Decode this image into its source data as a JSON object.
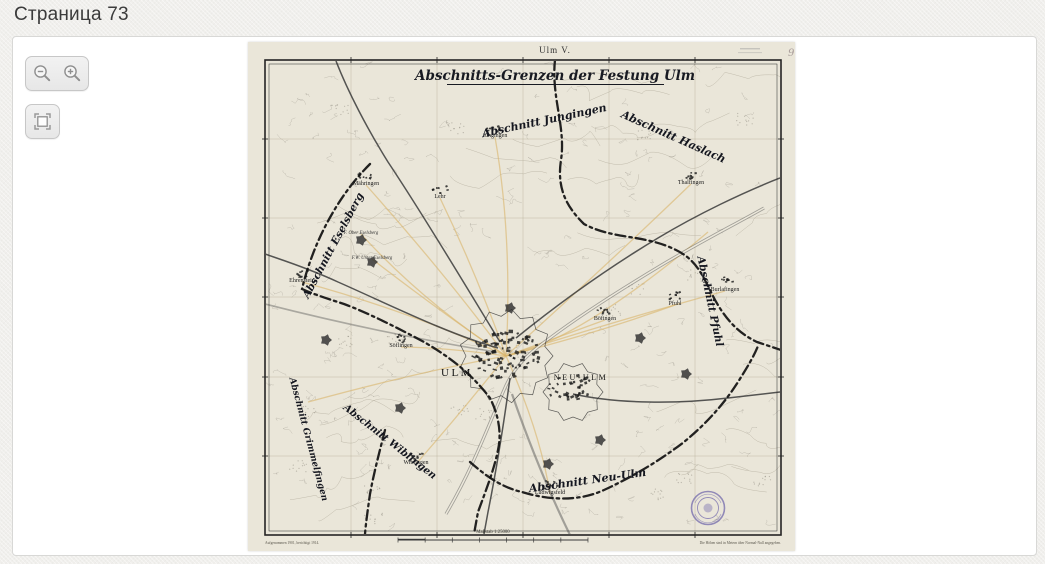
{
  "page": {
    "title": "Страница 73"
  },
  "toolbar": {
    "buttons": [
      {
        "name": "zoom-out",
        "icon": "magnifier-minus"
      },
      {
        "name": "zoom-in",
        "icon": "magnifier-plus"
      },
      {
        "name": "fit-fullscreen",
        "icon": "framed-square"
      }
    ]
  },
  "map": {
    "sheet_label": "Ulm V.",
    "corner_mark": "9",
    "title": "Abschnitts-Grenzen der Festung Ulm",
    "annotations": [
      {
        "text": "Abschnitt Jungingen",
        "x": 297,
        "y": 82,
        "rotate": -12,
        "size": 11
      },
      {
        "text": "Abschnitt Haslach",
        "x": 424,
        "y": 98,
        "rotate": 24,
        "size": 11
      },
      {
        "text": "Abschnitt Eselsberg",
        "x": 88,
        "y": 205,
        "rotate": -62,
        "size": 10.5
      },
      {
        "text": "Abschnitt Pfuhl",
        "x": 459,
        "y": 260,
        "rotate": 78,
        "size": 10.5
      },
      {
        "text": "Abschnitt Neu-Ulm",
        "x": 340,
        "y": 442,
        "rotate": -8,
        "size": 11
      },
      {
        "text": "Abschnitt Wiblingen",
        "x": 140,
        "y": 402,
        "rotate": 38,
        "size": 10
      },
      {
        "text": "Abschnitt Grimmelfingen",
        "x": 58,
        "y": 398,
        "rotate": 75,
        "size": 9
      }
    ],
    "places": [
      {
        "label": "Jungingen",
        "x": 247,
        "y": 95,
        "blob": true
      },
      {
        "label": "Mähringen",
        "x": 118,
        "y": 143,
        "blob": true
      },
      {
        "label": "Lehr",
        "x": 192,
        "y": 156,
        "blob": true
      },
      {
        "label": "Thalfingen",
        "x": 443,
        "y": 142,
        "blob": true
      },
      {
        "label": "Böfingen",
        "x": 357,
        "y": 278,
        "blob": true
      },
      {
        "label": "Pfuhl",
        "x": 427,
        "y": 263,
        "blob": true
      },
      {
        "label": "Burlafingen",
        "x": 477,
        "y": 249,
        "blob": true
      },
      {
        "label": "Ehrenstein",
        "x": 54,
        "y": 240,
        "blob": true
      },
      {
        "label": "Söflingen",
        "x": 153,
        "y": 305,
        "blob": true
      },
      {
        "label": "Wiblingen",
        "x": 168,
        "y": 422,
        "blob": true
      },
      {
        "label": "Ludwigsfeld",
        "x": 302,
        "y": 452,
        "blob": true
      },
      {
        "label": "F. Ober Eselsberg",
        "x": 113,
        "y": 192,
        "fort": true
      },
      {
        "label": "F.W. Unter Eselsberg",
        "x": 124,
        "y": 217,
        "fort": true
      },
      {
        "label": "ULM",
        "x": 209,
        "y": 334,
        "big": true,
        "size": 11
      },
      {
        "label": "NEU-ULM",
        "x": 333,
        "y": 338,
        "big": true,
        "size": 8
      }
    ],
    "footer": {
      "left_note": "Aufgenommen 1901, berichtigt 1914.",
      "scale_label": "Maßstab 1:25000",
      "right_note": "Die Höhen sind in Metern über Normal-Null angegeben."
    },
    "colors": {
      "paper": "#eae6d9",
      "ink": "#1d1d1d",
      "boundary": "#101010",
      "road": "#d9b469",
      "stamp": "#6f66ab"
    }
  }
}
